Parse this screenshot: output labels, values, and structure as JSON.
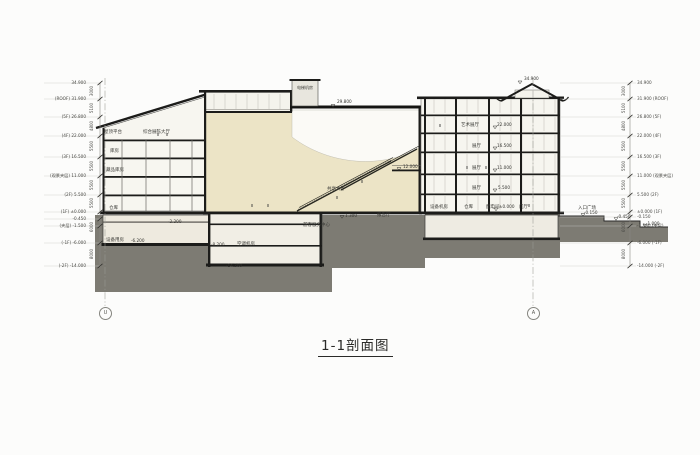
{
  "title": "1-1剖面图",
  "grid": {
    "left_bubble": "U",
    "right_bubble": "A"
  },
  "levels_left": [
    "34.900",
    "(ROOF) 31.900",
    "(5F) 26.800",
    "(4F) 22.000",
    "(3F) 16.500",
    "(观景夹层) 11.000",
    "(2F) 5.500",
    "(1F) ±0.000",
    "-0.450",
    "(夹层) -1.500",
    "(-1F) -6.000",
    "(-2F) -14.000"
  ],
  "levels_right": [
    "34.900",
    "31.900 (ROOF)",
    "26.800 (5F)",
    "22.000 (4F)",
    "16.500 (3F)",
    "11.000 (观景夹层)",
    "5.500 (2F)",
    "±0.000 (1F)",
    "-0.150",
    "-1.500 (夹层)",
    "-6.000 (-1F)",
    "-14.000 (-2F)"
  ],
  "dims_left": [
    "3000",
    "5100",
    "4800",
    "5500",
    "5500",
    "5500",
    "5500",
    "6000",
    "8000"
  ],
  "dims_right": [
    "3000",
    "5100",
    "4800",
    "5500",
    "5500",
    "5500",
    "5500",
    "6000",
    "8000"
  ],
  "rooms": [
    {
      "t": "屋顶平台"
    },
    {
      "t": "综合展陈大厅"
    },
    {
      "t": "电梯机房"
    },
    {
      "t": "艺术展厅"
    },
    {
      "t": "展厅"
    },
    {
      "t": "展厅"
    },
    {
      "t": "展厅"
    },
    {
      "t": "门厅"
    },
    {
      "t": "配电间"
    },
    {
      "t": "仓库"
    },
    {
      "t": "设备机房"
    },
    {
      "t": "入口广场"
    },
    {
      "t": "游客服务中心"
    },
    {
      "t": "报告厅"
    },
    {
      "t": "共享大厅"
    },
    {
      "t": "空调机房"
    },
    {
      "t": "设备用房"
    },
    {
      "t": "仓库"
    },
    {
      "t": "藏品库房"
    },
    {
      "t": "库房"
    }
  ],
  "markers": [
    {
      "t": "29.800"
    },
    {
      "t": "34.900"
    },
    {
      "t": "22.000"
    },
    {
      "t": "16.500"
    },
    {
      "t": "11.000"
    },
    {
      "t": "5.500"
    },
    {
      "t": "±0.000"
    },
    {
      "t": "-0.150"
    },
    {
      "t": "-0.450"
    },
    {
      "t": "-1.000"
    },
    {
      "t": "12.000"
    },
    {
      "t": "1.300"
    },
    {
      "t": "-2.200"
    },
    {
      "t": "-6.200"
    },
    {
      "t": "-8.200"
    },
    {
      "t": "-14.200"
    }
  ],
  "colors": {
    "ground": "#7d7b73",
    "atrium_fill": "#ece4c6",
    "slab": "#1c1c1a",
    "paper": "#fcfcfb"
  }
}
